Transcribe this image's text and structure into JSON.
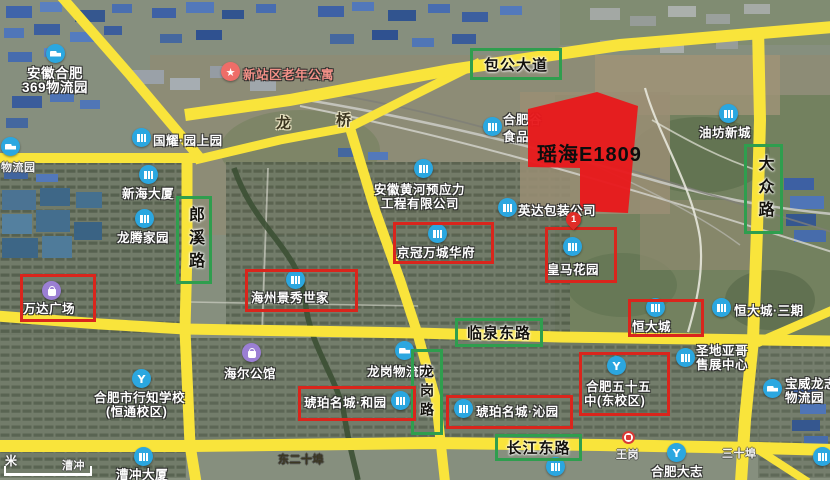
{
  "parcel": {
    "label": "瑶海E1809",
    "fill": "#e8191c"
  },
  "roads": {
    "baogong": "包公大道",
    "langxi": "郎溪路",
    "dazhong": "大众路",
    "linquan": "临泉东路",
    "longgang": "龙岗路",
    "changjiang": "长江东路"
  },
  "bridge": {
    "left": "龙",
    "right": "桥"
  },
  "pois": {
    "anhui369": {
      "lines": [
        "安徽合肥",
        "369物流园"
      ],
      "icon": "truck"
    },
    "xinzhan": {
      "lines": [
        "新站区老年公寓"
      ],
      "icon": "star"
    },
    "guoyao": {
      "lines": [
        "国耀·园上园"
      ],
      "icon": "building"
    },
    "hefeigu": {
      "lines": [
        "合肥谷",
        "食品"
      ],
      "icon": "building"
    },
    "yingda": {
      "lines": [
        "英达包装公司"
      ],
      "icon": "building"
    },
    "huanghe": {
      "lines": [
        "安徽黄河预应力",
        "工程有限公司"
      ],
      "icon": "building"
    },
    "jingguan": {
      "lines": [
        "京冠万城华府"
      ],
      "icon": "building",
      "boxed": true
    },
    "haizhou": {
      "lines": [
        "海州景秀世家"
      ],
      "icon": "building",
      "boxed": true
    },
    "huangma": {
      "lines": [
        "皇马花园"
      ],
      "icon": "building",
      "boxed": true,
      "pin": "1"
    },
    "wanda": {
      "lines": [
        "万达广场"
      ],
      "icon": "bag",
      "boxed": true
    },
    "xinhai": {
      "lines": [
        "新海大厦"
      ],
      "icon": "building"
    },
    "longteng": {
      "lines": [
        "龙腾家园"
      ],
      "icon": "building"
    },
    "hengdacheng": {
      "lines": [
        "恒大城"
      ],
      "icon": "building",
      "boxed": true
    },
    "hengda3": {
      "lines": [
        "恒大城·三期"
      ],
      "icon": "building"
    },
    "shengdiyage": {
      "lines": [
        "圣地亚哥",
        "售展中心"
      ],
      "icon": "building"
    },
    "baowei": {
      "lines": [
        "宝威龙志",
        "物流园"
      ],
      "icon": "truck"
    },
    "wushiwu": {
      "lines": [
        "合肥五十五",
        "中(东校区)"
      ],
      "icon": "school",
      "boxed": true
    },
    "longgangwl": {
      "lines": [
        "龙岗物流园"
      ],
      "icon": "truck"
    },
    "hupohe": {
      "lines": [
        "琥珀名城·和园"
      ],
      "icon": "building",
      "boxed": true
    },
    "hupoqin": {
      "lines": [
        "琥珀名城·沁园"
      ],
      "icon": "building",
      "boxed": true
    },
    "haier": {
      "lines": [
        "海尔公馆"
      ],
      "icon": "bag"
    },
    "xingzhi": {
      "lines": [
        "合肥市行知学校",
        "(恒通校区)"
      ],
      "icon": "school"
    },
    "caochongdasha": {
      "lines": [
        "漕冲大厦"
      ],
      "icon": "building"
    },
    "youfang": {
      "lines": [
        "油坊新城"
      ],
      "icon": "building"
    },
    "dazhi": {
      "lines": [
        "合肥大志"
      ],
      "icon": "school"
    },
    "wuliu_edge": {
      "lines": [
        "物流园"
      ],
      "icon": "truck"
    }
  },
  "minor": {
    "caochong": "漕冲",
    "dongershipu": "东二十埠",
    "wanggang": "王岗",
    "sanshipu": "三十埠"
  },
  "scalebar": {
    "unit": "米"
  }
}
